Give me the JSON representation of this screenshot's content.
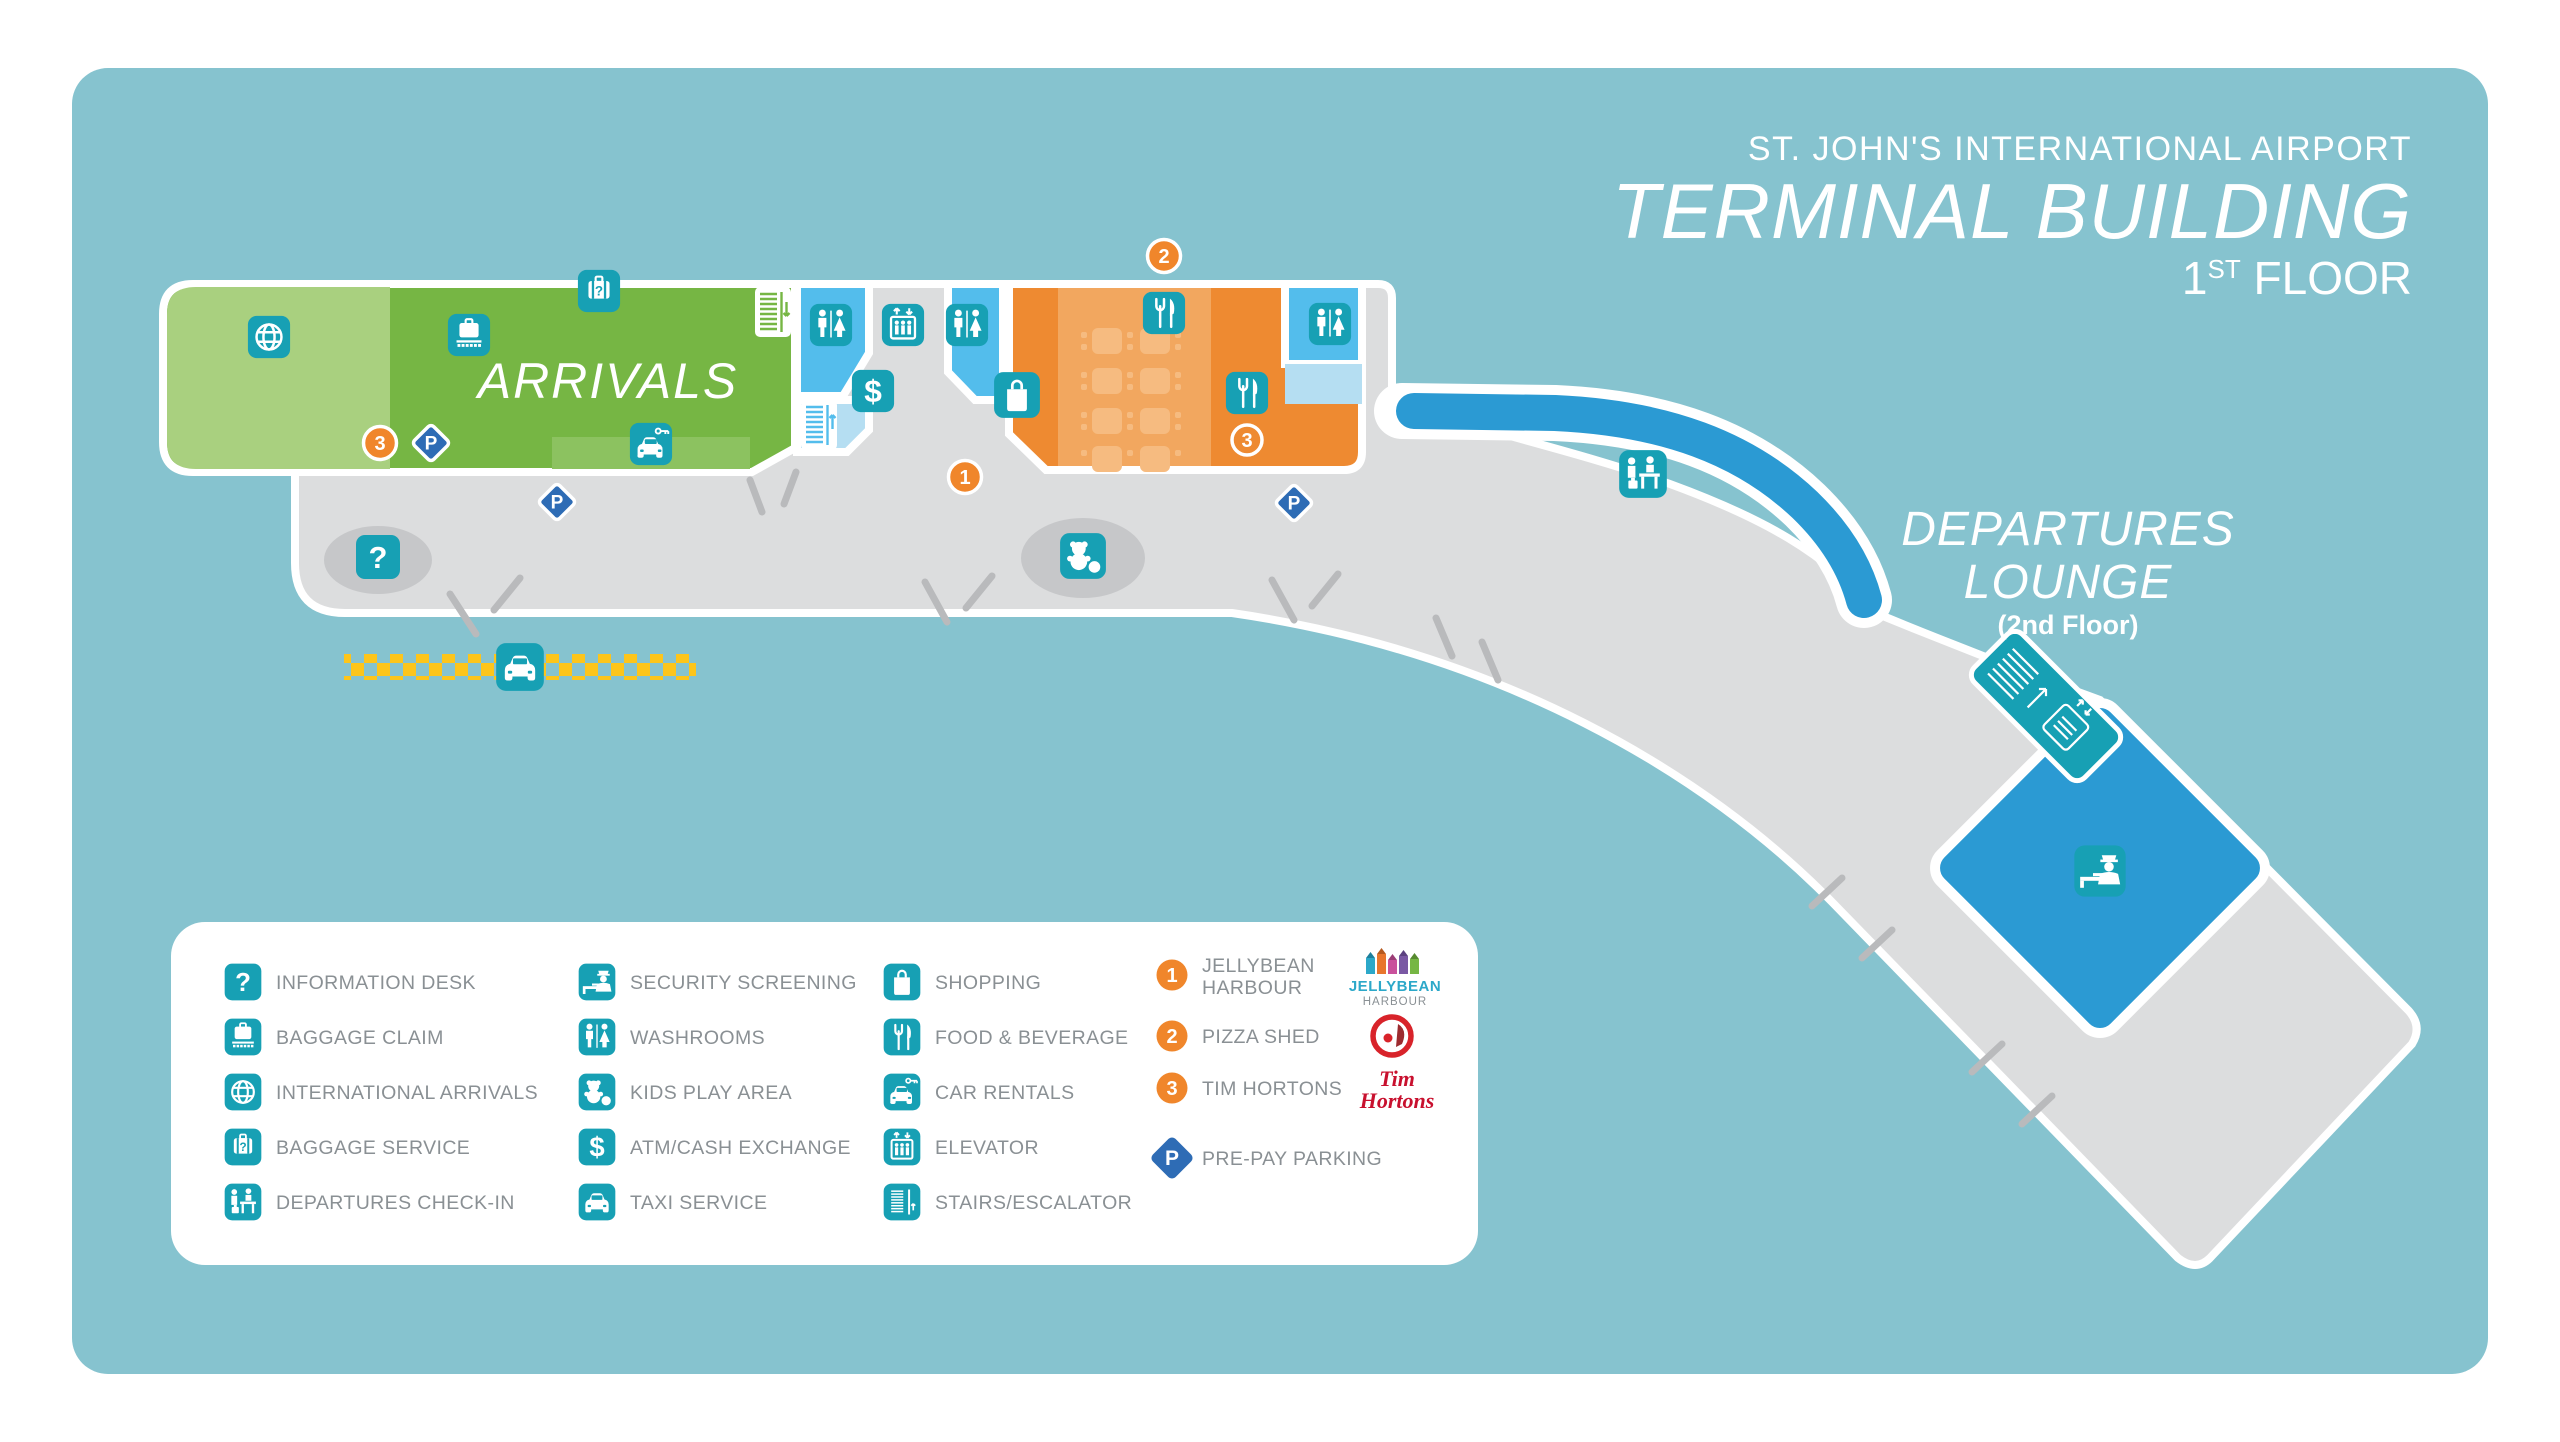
{
  "title": {
    "airport": "ST. JOHN'S INTERNATIONAL AIRPORT",
    "building": "TERMINAL BUILDING",
    "floor_number": "1",
    "floor_ordinal": "ST",
    "floor_word": " FLOOR"
  },
  "map": {
    "arrivals_label": "ARRIVALS",
    "departures_line1": "DEPARTURES",
    "departures_line2": "LOUNGE",
    "departures_line3": "(2nd Floor)"
  },
  "markers": {
    "jellybean": "1",
    "pizza_shed": "2",
    "tim_hortons": "3",
    "parking": "P"
  },
  "legend": {
    "column1": [
      {
        "icon": "information-desk",
        "label": "INFORMATION DESK"
      },
      {
        "icon": "baggage-claim",
        "label": "BAGGAGE CLAIM"
      },
      {
        "icon": "international-arrivals",
        "label": "INTERNATIONAL ARRIVALS"
      },
      {
        "icon": "baggage-service",
        "label": "BAGGAGE SERVICE"
      },
      {
        "icon": "departures-check-in",
        "label": "DEPARTURES CHECK-IN"
      }
    ],
    "column2": [
      {
        "icon": "security-screening",
        "label": "SECURITY SCREENING"
      },
      {
        "icon": "washrooms",
        "label": "WASHROOMS"
      },
      {
        "icon": "kids-play-area",
        "label": "KIDS PLAY AREA"
      },
      {
        "icon": "atm-cash-exchange",
        "label": "ATM/CASH EXCHANGE"
      },
      {
        "icon": "taxi-service",
        "label": "TAXI SERVICE"
      }
    ],
    "column3": [
      {
        "icon": "shopping",
        "label": "SHOPPING"
      },
      {
        "icon": "food-beverage",
        "label": "FOOD & BEVERAGE"
      },
      {
        "icon": "car-rentals",
        "label": "CAR RENTALS"
      },
      {
        "icon": "elevator",
        "label": "ELEVATOR"
      },
      {
        "icon": "stairs-escalator",
        "label": "STAIRS/ESCALATOR"
      }
    ],
    "vendors": [
      {
        "num": "1",
        "line1": "JELLYBEAN",
        "line2": "HARBOUR"
      },
      {
        "num": "2",
        "line1": "PIZZA SHED",
        "line2": ""
      },
      {
        "num": "3",
        "line1": "TIM HORTONS",
        "line2": ""
      }
    ],
    "parking": {
      "symbol": "P",
      "label": "PRE-PAY PARKING"
    }
  },
  "logos": {
    "jellybean": {
      "line1": "JELLYBEAN",
      "line2": "HARBOUR"
    },
    "tim_hortons": {
      "line1": "Tim",
      "line2": "Hortons"
    }
  },
  "colors": {
    "canvas_teal": "#86c3cf",
    "concourse_gray": "#dcddde",
    "arrivals_green": "#76b644",
    "arrivals_light_green": "#a9d07f",
    "arrivals_inset_green": "#8cc260",
    "washroom_blue": "#53bdec",
    "washroom_light_blue": "#b5def2",
    "food_orange": "#ee8a31",
    "food_light_orange": "#f2a75f",
    "food_table_orange": "#f6bb80",
    "walkway_blue": "#2b9ad3",
    "departures_blue": "#2b9ad3",
    "icon_teal": "#17a0b4",
    "parking_blue": "#2e6cb5",
    "marker_orange": "#f0862b",
    "taxi_yellow": "#fdc51b",
    "legend_text_gray": "#8a9094",
    "logo_red": "#c8102e",
    "ellipse_gray": "#c6c7c9"
  }
}
